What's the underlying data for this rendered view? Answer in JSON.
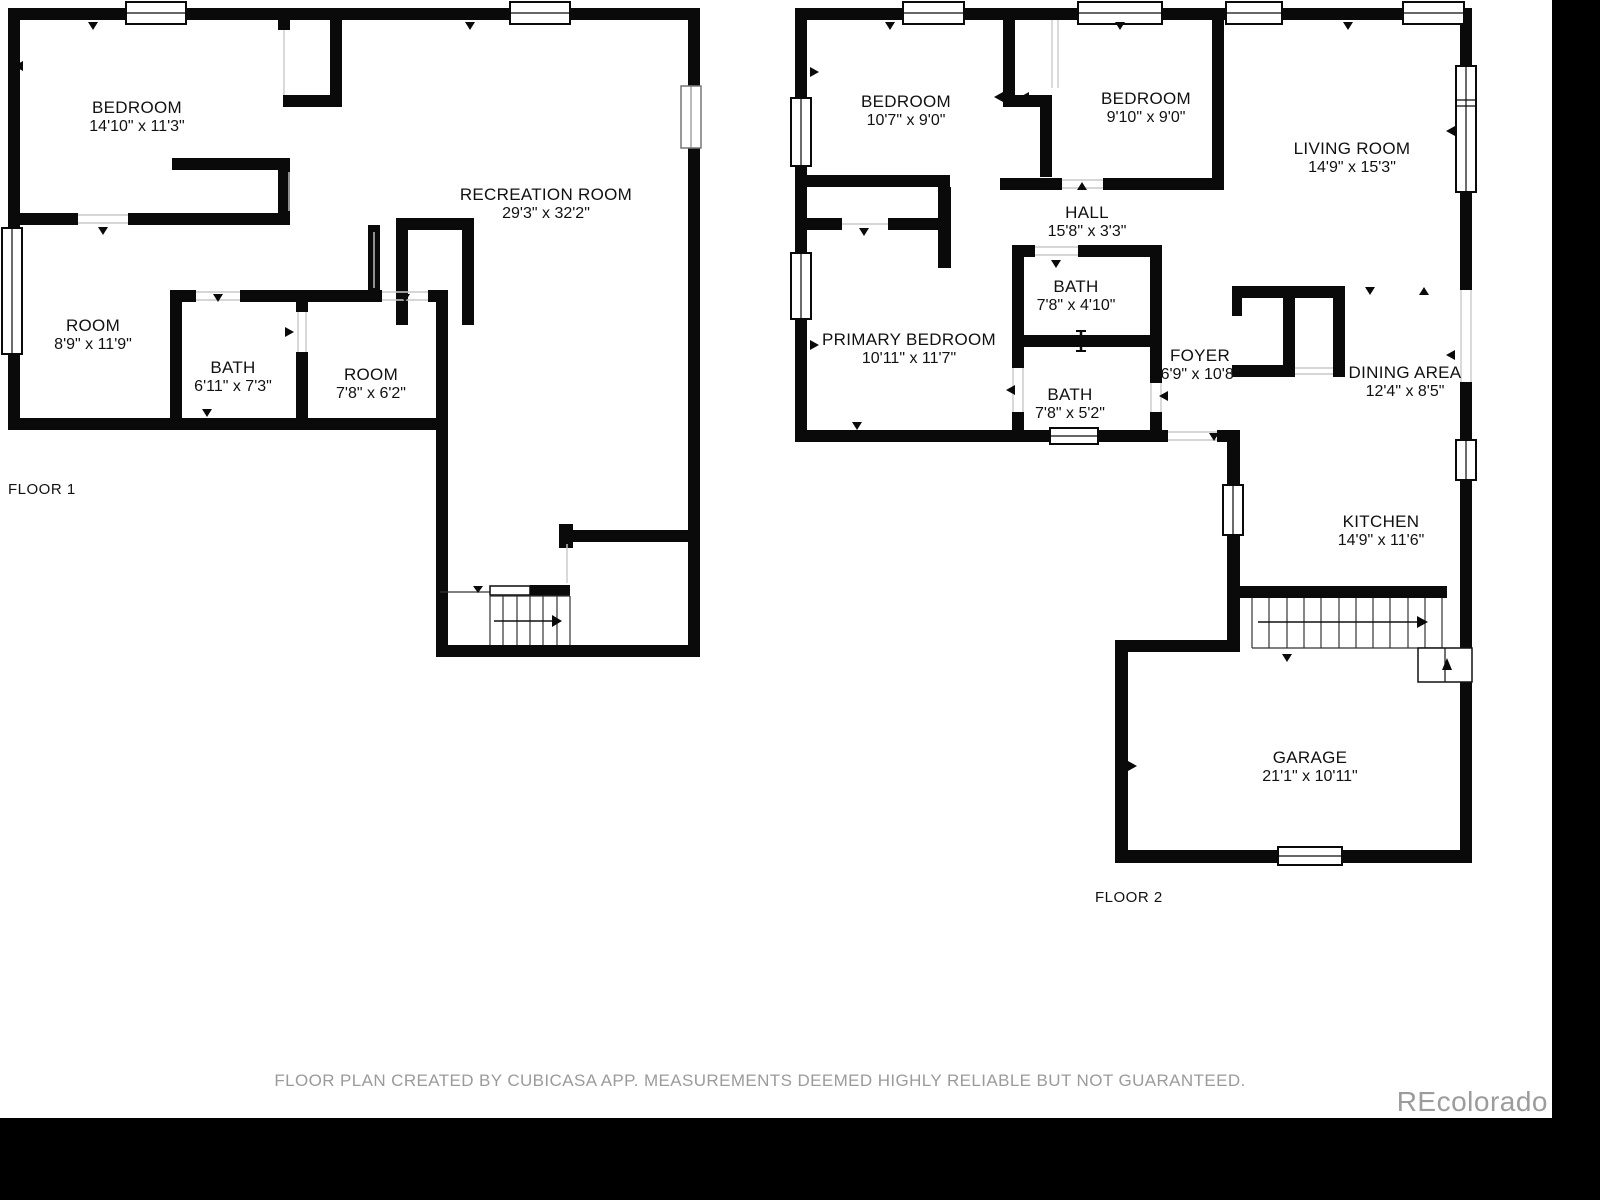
{
  "canvas": {
    "width": 1600,
    "height": 1200,
    "background": "#ffffff",
    "wall_color": "#0a0a0a",
    "text_color": "#111111"
  },
  "floor1": {
    "label": "FLOOR 1",
    "rooms": [
      {
        "name": "BEDROOM",
        "dims": "14'10\" x 11'3\"",
        "x": 137,
        "y": 117
      },
      {
        "name": "RECREATION ROOM",
        "dims": "29'3\" x 32'2\"",
        "x": 546,
        "y": 204
      },
      {
        "name": "ROOM",
        "dims": "8'9\" x 11'9\"",
        "x": 93,
        "y": 335
      },
      {
        "name": "BATH",
        "dims": "6'11\" x 7'3\"",
        "x": 233,
        "y": 377
      },
      {
        "name": "ROOM",
        "dims": "7'8\" x 6'2\"",
        "x": 371,
        "y": 384
      }
    ]
  },
  "floor2": {
    "label": "FLOOR 2",
    "rooms": [
      {
        "name": "BEDROOM",
        "dims": "10'7\" x 9'0\"",
        "x": 906,
        "y": 111
      },
      {
        "name": "BEDROOM",
        "dims": "9'10\" x 9'0\"",
        "x": 1146,
        "y": 108
      },
      {
        "name": "LIVING ROOM",
        "dims": "14'9\" x 15'3\"",
        "x": 1352,
        "y": 158
      },
      {
        "name": "HALL",
        "dims": "15'8\" x 3'3\"",
        "x": 1087,
        "y": 222
      },
      {
        "name": "BATH",
        "dims": "7'8\" x 4'10\"",
        "x": 1076,
        "y": 296
      },
      {
        "name": "PRIMARY BEDROOM",
        "dims": "10'11\" x 11'7\"",
        "x": 909,
        "y": 349
      },
      {
        "name": "BATH",
        "dims": "7'8\" x 5'2\"",
        "x": 1070,
        "y": 404
      },
      {
        "name": "FOYER",
        "dims": "6'9\" x 10'8\"",
        "x": 1200,
        "y": 365
      },
      {
        "name": "DINING AREA",
        "dims": "12'4\" x 8'5\"",
        "x": 1405,
        "y": 382
      },
      {
        "name": "KITCHEN",
        "dims": "14'9\" x 11'6\"",
        "x": 1381,
        "y": 531
      },
      {
        "name": "GARAGE",
        "dims": "21'1\" x 10'11\"",
        "x": 1310,
        "y": 767
      }
    ]
  },
  "footer": {
    "disclaimer": "FLOOR PLAN CREATED BY CUBICASA APP. MEASUREMENTS DEEMED HIGHLY RELIABLE BUT NOT GUARANTEED."
  },
  "watermark": {
    "text": "REcolorado",
    "color": "#9c9c9c"
  }
}
